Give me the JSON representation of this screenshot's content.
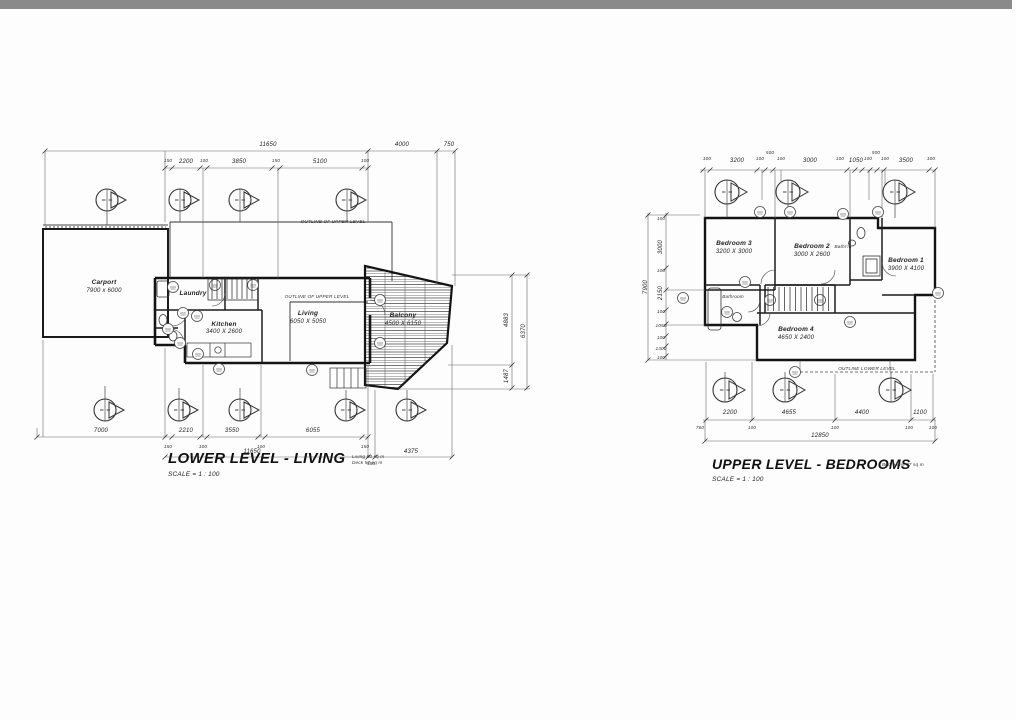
{
  "drawing": {
    "lower": {
      "title": "LOWER LEVEL - LIVING",
      "area_note_line1": "Living 50 sq m",
      "area_note_line2": "Deck 57 sq m",
      "scale": "SCALE = 1 : 100",
      "upper_outline_note_top": "OUTLINE OF UPPER LEVEL",
      "upper_outline_note_inner": "OUTLINE OF UPPER LEVEL",
      "rooms": {
        "carport_name": "Carport",
        "carport_size": "7900 x 6000",
        "laundry_name": "Laundry",
        "kitchen_name": "Kitchen",
        "kitchen_size": "3400 X 2600",
        "living_name": "Living",
        "living_size": "6050 X 5050",
        "balcony_name": "Balcony",
        "balcony_size": "4500 X 6150"
      },
      "dims": {
        "top_overall_1": "11650",
        "top_overall_2": "4000",
        "top_overall_3": "750",
        "top_d1": "150",
        "top_d2": "2200",
        "top_d3": "100",
        "top_d4": "3850",
        "top_d5": "150",
        "top_d6": "5100",
        "top_d7": "100",
        "right_1": "4883",
        "right_2": "1487",
        "right_3": "6370",
        "bot_d1": "7000",
        "bot_d2": "2210",
        "bot_d3": "3550",
        "bot_d4": "6055",
        "bot_s1": "150",
        "bot_s2": "100",
        "bot_s3": "100",
        "bot_s4": "150",
        "bot_overall": "11650",
        "bot_right": "4375",
        "bot_offset": "580"
      }
    },
    "upper": {
      "title": "UPPER LEVEL - BEDROOMS",
      "area_note": "Bedrooms 87 sq m",
      "scale": "SCALE = 1 : 100",
      "lower_outline_note": "OUTLINE LOWER LEVEL",
      "rooms": {
        "bedroom3_name": "Bedroom 3",
        "bedroom3_size": "3200 X 3000",
        "bedroom2_name": "Bedroom 2",
        "bedroom2_size": "3000 X 2600",
        "bathroom2_name": "Bathr'm",
        "bedroom1_name": "Bedroom 1",
        "bedroom1_size": "3900 X 4100",
        "bathroom_name": "Bathroom",
        "bedroom4_name": "Bedroom 4",
        "bedroom4_size": "4650 X 2400"
      },
      "dims": {
        "top": [
          "100",
          "3200",
          "100",
          "500",
          "100",
          "3000",
          "100",
          "1050",
          "100",
          "500",
          "100",
          "3500",
          "100"
        ],
        "left": [
          "100",
          "3000",
          "100",
          "2150",
          "100",
          "1050",
          "100",
          "1300",
          "100"
        ],
        "left_overall": "7900",
        "bot_d1": "2200",
        "bot_d2": "4655",
        "bot_d3": "4400",
        "bot_d4": "1100",
        "bot_s0": "760",
        "bot_s1": "100",
        "bot_s2": "100",
        "bot_s3": "100",
        "bot_s4": "100",
        "bot_overall": "12850"
      }
    }
  }
}
